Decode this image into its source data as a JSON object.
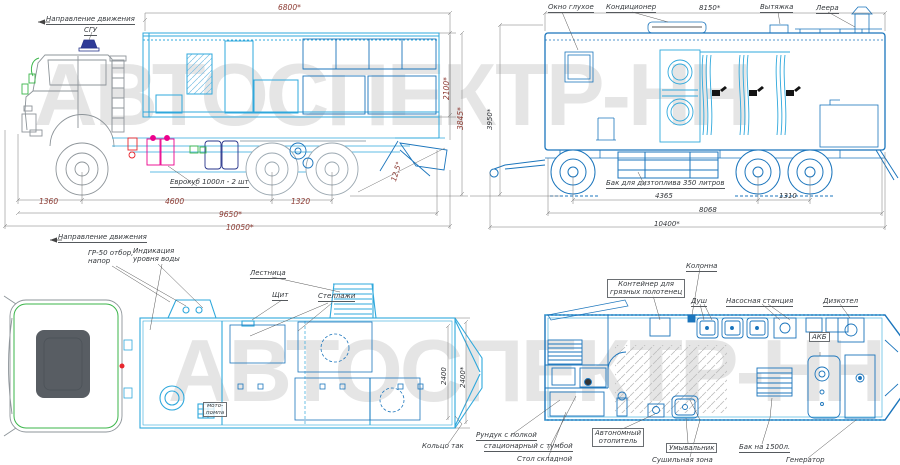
{
  "watermark": {
    "text": "АВТОСПЕКТР-НН"
  },
  "colors": {
    "line_cyan": "#2FA8DC",
    "line_blue": "#1B75BC",
    "cab_gray": "#8d9499",
    "accent_green": "#3BB54A",
    "accent_magenta": "#EC008C",
    "accent_red": "#E8262D",
    "accent_navy": "#27348B",
    "dim_maroon": "#8c3a32",
    "watermark_gray": "#e5e5e5"
  },
  "side_view": {
    "direction": "Направление движения",
    "sgu": "СГУ",
    "eurocube": "Еврокуб 1000л - 2 шт",
    "dims": {
      "length_top": "6800*",
      "body_height": "2100*",
      "total_height": "3845*",
      "departure_angle": "12,5°",
      "front_overhang": "1360",
      "wheelbase": "4600",
      "bogie_base": "1320",
      "length_mid": "9650*",
      "length_total": "10050*"
    }
  },
  "curb_view": {
    "window": "Окно глухое",
    "ac": "Кондиционер",
    "vent": "Вытяжка",
    "rails": "Леера",
    "fuel_tank": "Бак для дизтоплива 350 литров",
    "dims": {
      "length_top": "8150*",
      "height": "3950*",
      "axle_spread": "4365",
      "bogie": "1310",
      "frame": "8068",
      "total": "10400*"
    }
  },
  "plan_view": {
    "direction": "Направление движения",
    "gr50_line1": "ГР-50 отбор,",
    "gr50_line2": "напор",
    "indicator_line1": "Индикация",
    "indicator_line2": "уровня воды",
    "ladder": "Лестница",
    "shield": "Щит",
    "shelves": "Стеллажи",
    "ring": "Кольцо так",
    "pump_line1": "мото-",
    "pump_line2": "помпа",
    "dims": {
      "inner_width": "2400",
      "width": "2400*"
    }
  },
  "interior_view": {
    "container_line1": "Контейнер для",
    "container_line2": "грязных полотенец",
    "column": "Колонна",
    "shower": "Душ",
    "pump_station": "Насосная станция",
    "boiler": "Дизкотел",
    "battery": "АКБ",
    "locker_line1": "Рундук с полкой",
    "locker_line2": "стационарный с тумбой",
    "table": "Стол складной",
    "heater_line1": "Автономный",
    "heater_line2": "отопитель",
    "sink": "Умывальник",
    "drying": "Сушильная зона",
    "water_tank": "Бак на 1500л.",
    "generator": "Генератор"
  }
}
